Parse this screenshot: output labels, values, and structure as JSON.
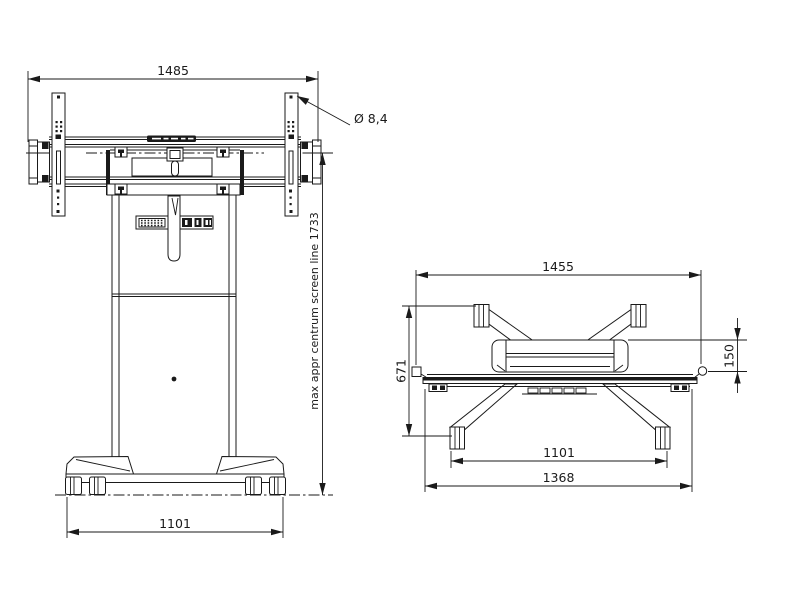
{
  "drawing": {
    "description": "technical dimension drawing of a mobile motorized display lift stand, front view and top view",
    "colors": {
      "line": "#1a1a1a",
      "background": "#ffffff"
    },
    "front_view": {
      "dims": {
        "top_width": "1485",
        "hole_diameter": "Ø 8,4",
        "screen_line": "max appr centrum screen line 1733",
        "base_width": "1101"
      }
    },
    "top_view": {
      "dims": {
        "top_width": "1455",
        "side_depth": "671",
        "front_offset": "150",
        "wheel_span": "1101",
        "overall_width": "1368"
      }
    }
  }
}
